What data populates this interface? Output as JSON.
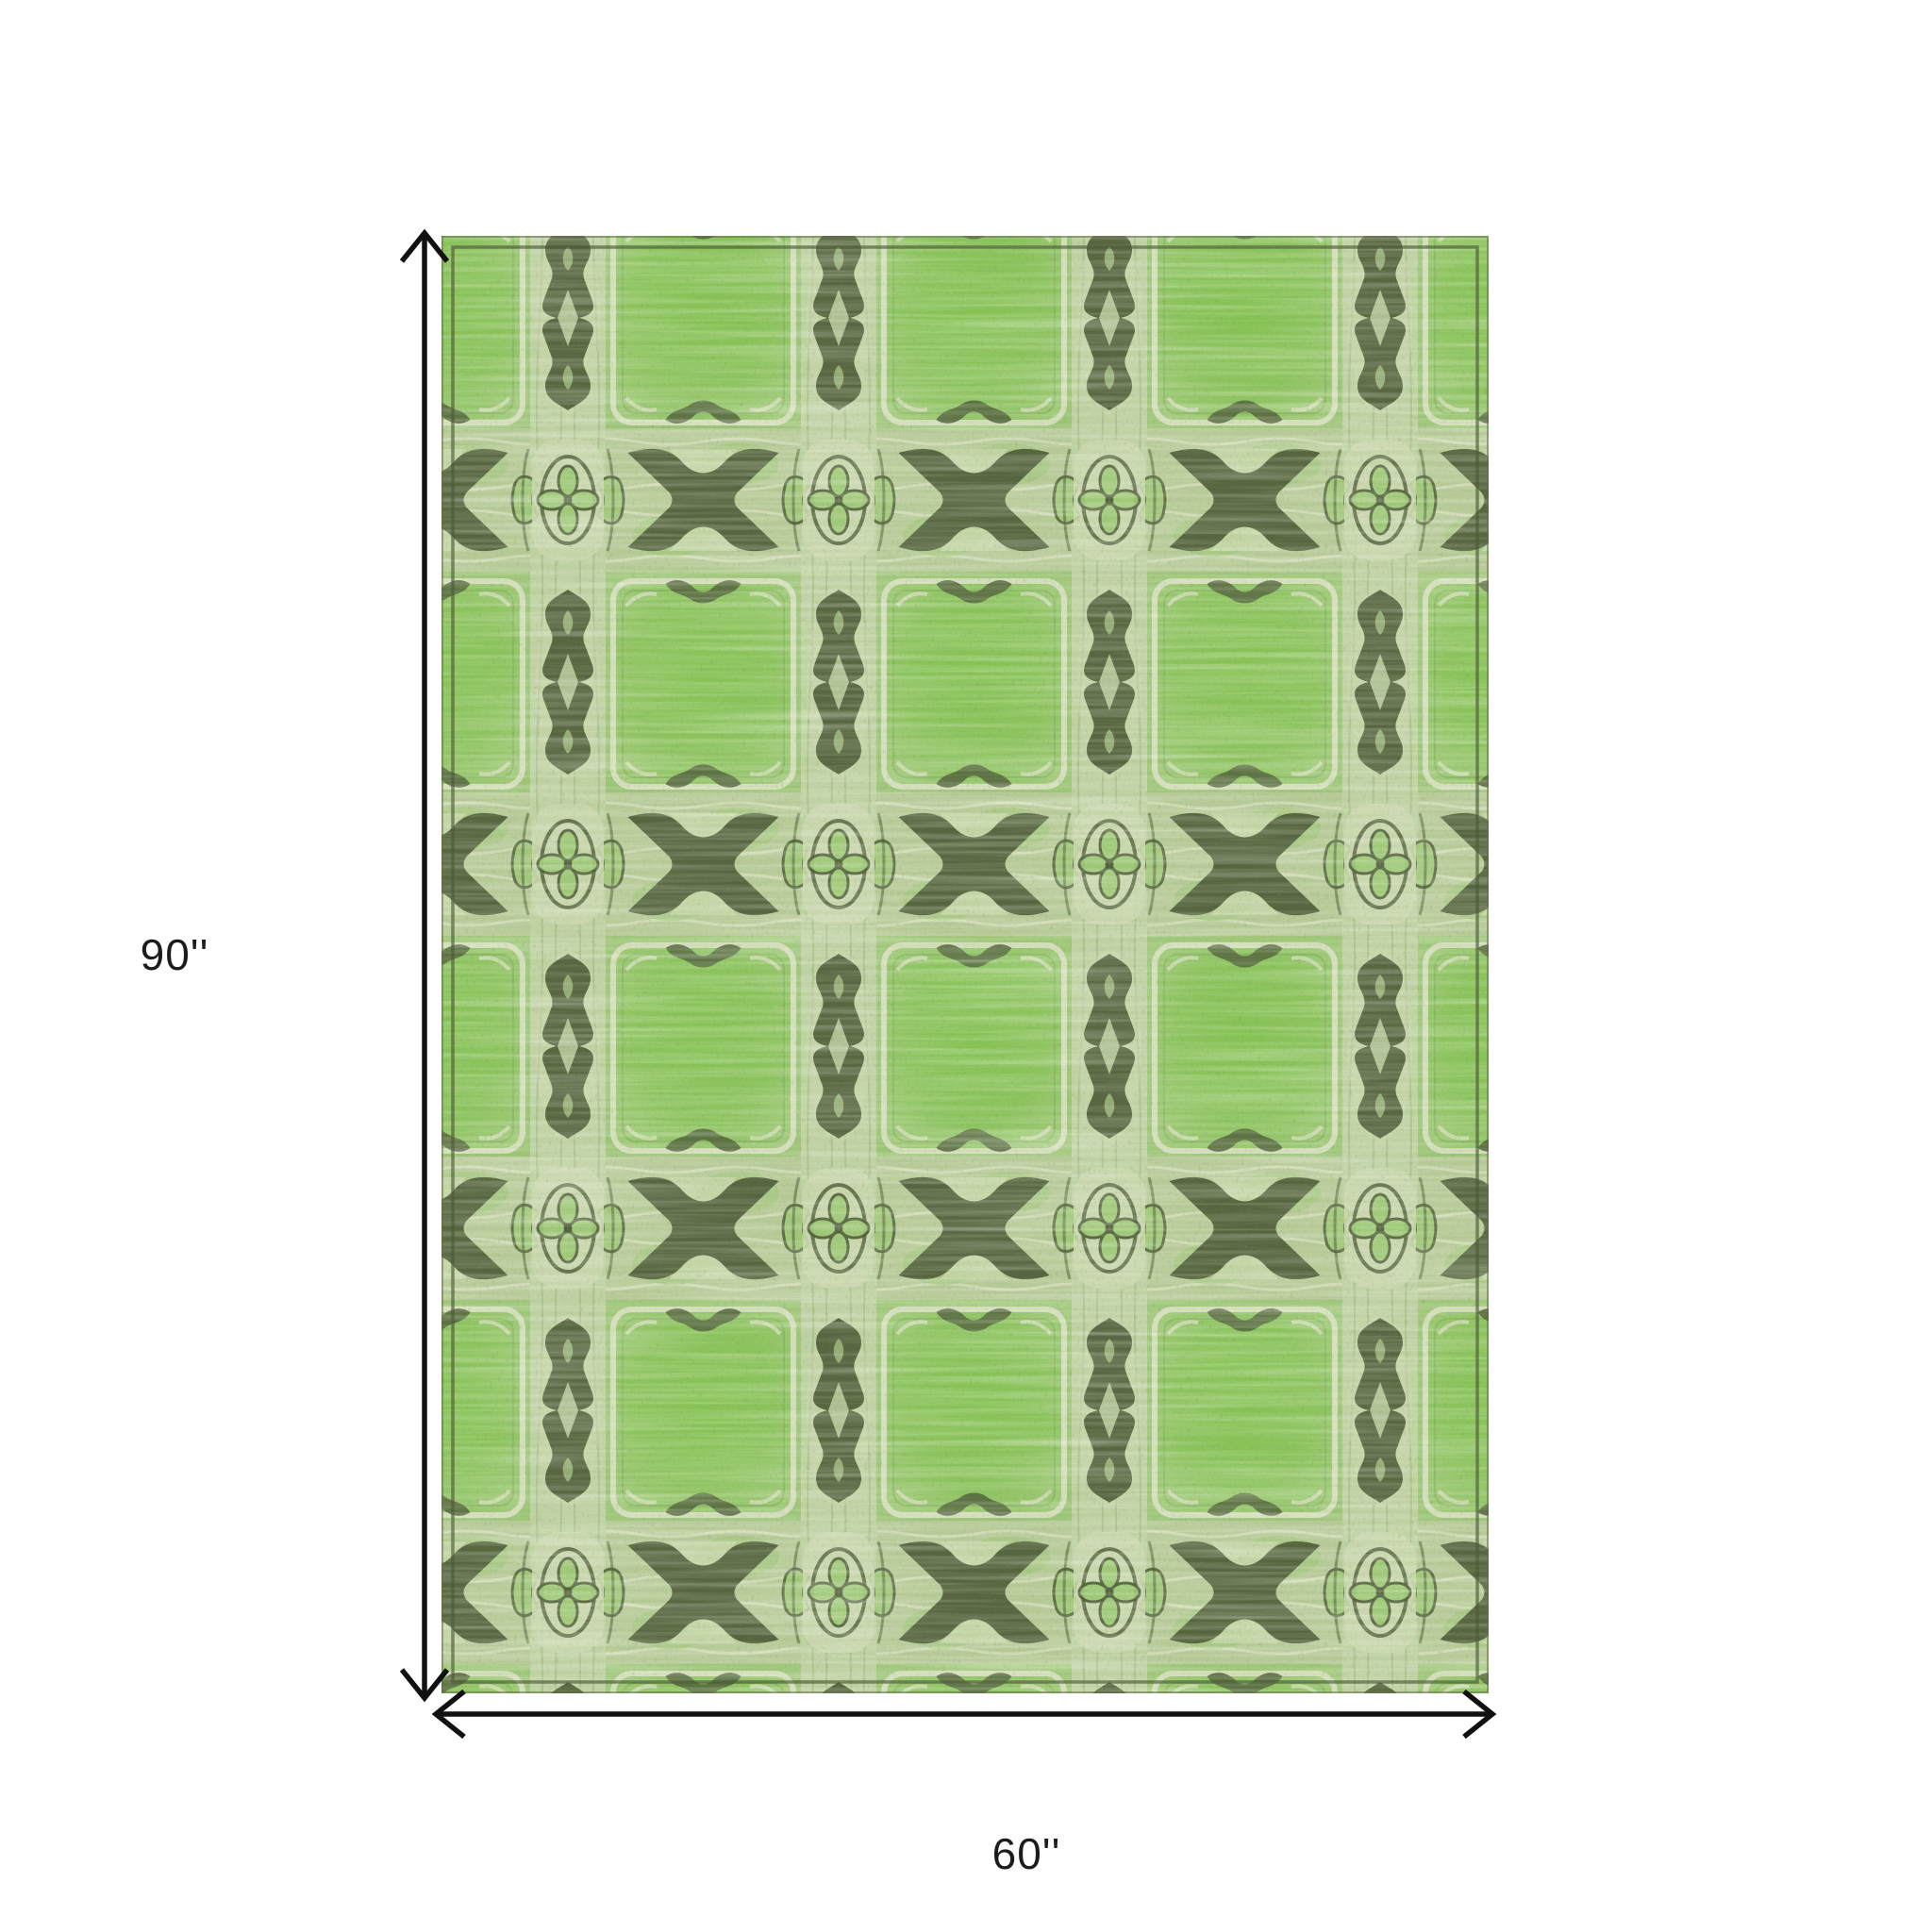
{
  "diagram": {
    "type": "product-dimension-diagram",
    "product": "Green distressed ikat plaid patterned area rug",
    "height_label": "90''",
    "width_label": "60''",
    "arrow_color": "#111111",
    "label_color": "#1c1c1c",
    "background": "#ffffff"
  },
  "rug": {
    "description": "Rectangular machine-woven rug: lime-green mottled squares in a plaid grid, pale sage bands and columns, dark olive X motifs, hourglass totem columns and quatrefoil oval medallions",
    "colors": {
      "base_green": "#9bc476",
      "panel_green": "#8cc35e",
      "panel_glow": "#86c254",
      "panel_edge": "#d2ddb9",
      "band_sage": "#b6ca97",
      "column_sage": "#bed1a2",
      "motif_olive": "#4f5e39",
      "border_olive": "#4c5a36"
    }
  }
}
